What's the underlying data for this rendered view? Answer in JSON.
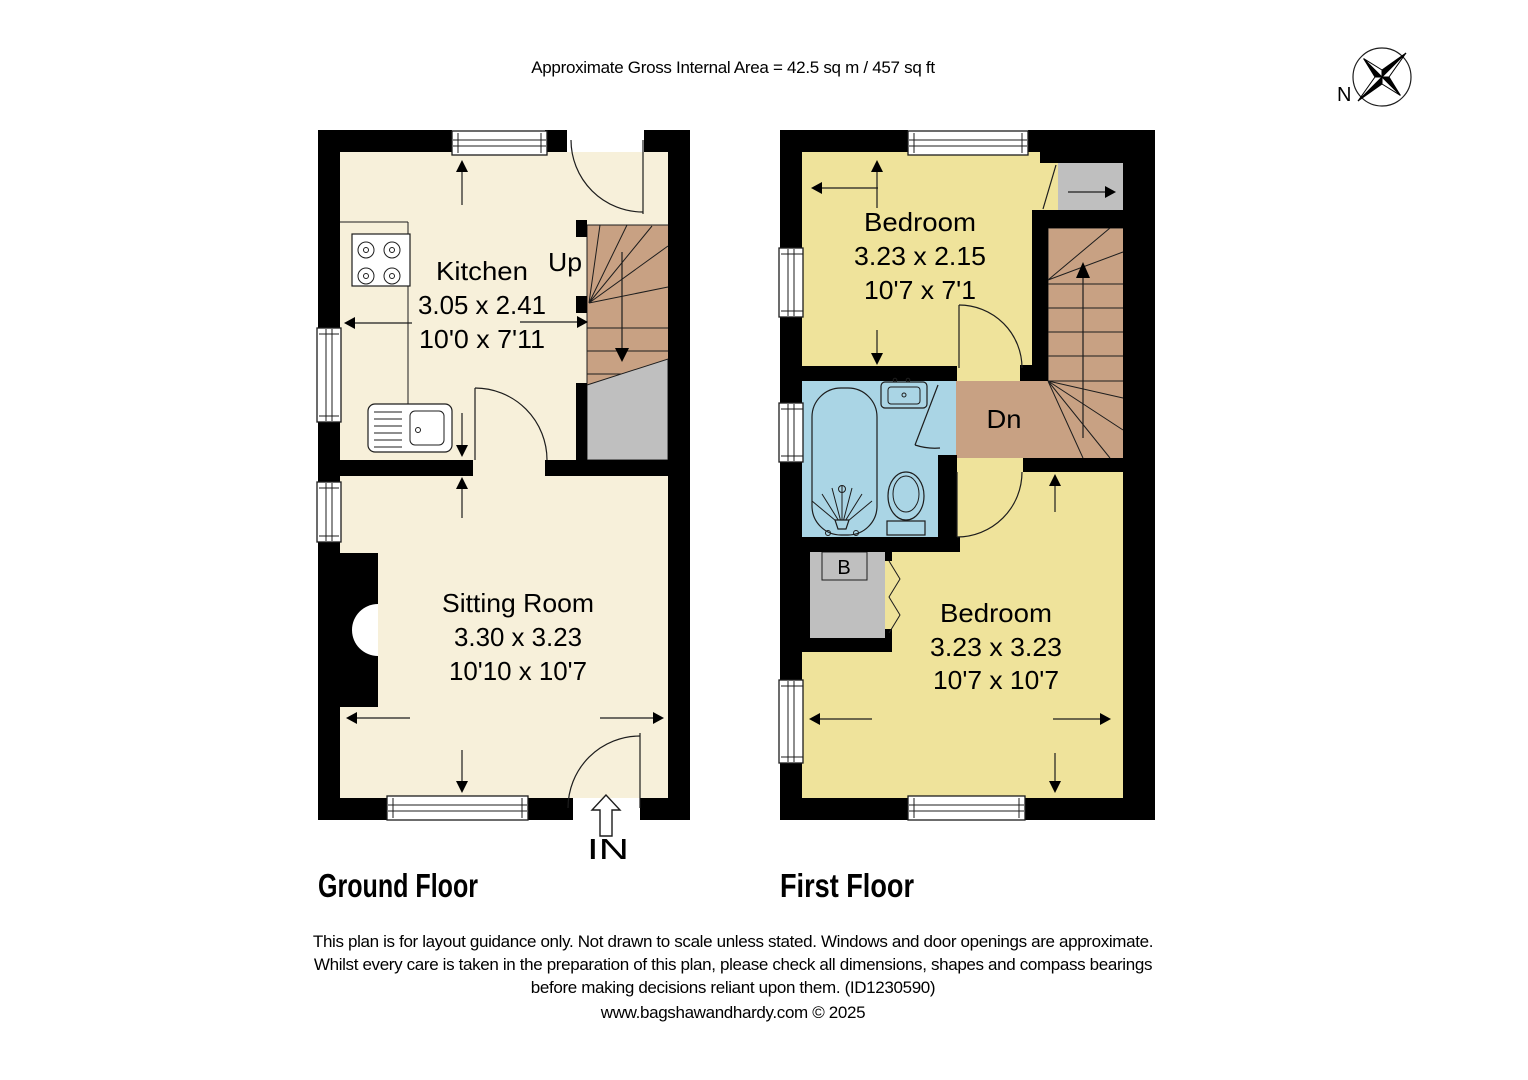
{
  "header": {
    "area_text": "Approximate Gross Internal Area = 42.5 sq m / 457 sq ft"
  },
  "compass": {
    "north_label": "N"
  },
  "ground_floor": {
    "title": "Ground Floor",
    "stairs_label": "Up",
    "entrance_label": "IN",
    "rooms": [
      {
        "name": "Kitchen",
        "size_metric": "3.05 x 2.41",
        "size_imperial": "10'0 x 7'11"
      },
      {
        "name": "Sitting Room",
        "size_metric": "3.30 x 3.23",
        "size_imperial": "10'10 x 10'7"
      }
    ]
  },
  "first_floor": {
    "title": "First Floor",
    "stairs_label": "Dn",
    "boiler_label": "B",
    "rooms": [
      {
        "name": "Bedroom",
        "size_metric": "3.23 x 2.15",
        "size_imperial": "10'7 x 7'1"
      },
      {
        "name": "Bedroom",
        "size_metric": "3.23 x 3.23",
        "size_imperial": "10'7 x 10'7"
      }
    ]
  },
  "footer": {
    "line1": "This plan is for layout guidance only. Not drawn to scale unless stated. Windows and door openings are approximate.",
    "line2": "Whilst every care is taken in the preparation of this plan, please check all dimensions, shapes and compass bearings",
    "line3": "before making decisions reliant upon them. (ID1230590)",
    "credit": "www.bagshawandhardy.com © 2025"
  },
  "colors": {
    "cream": "#f7f0da",
    "yellow": "#efe39b",
    "tan": "#c8a183",
    "blue": "#aad5e5",
    "gray": "#bfbfbf",
    "wall": "#000000",
    "line": "#1d1d1d"
  }
}
